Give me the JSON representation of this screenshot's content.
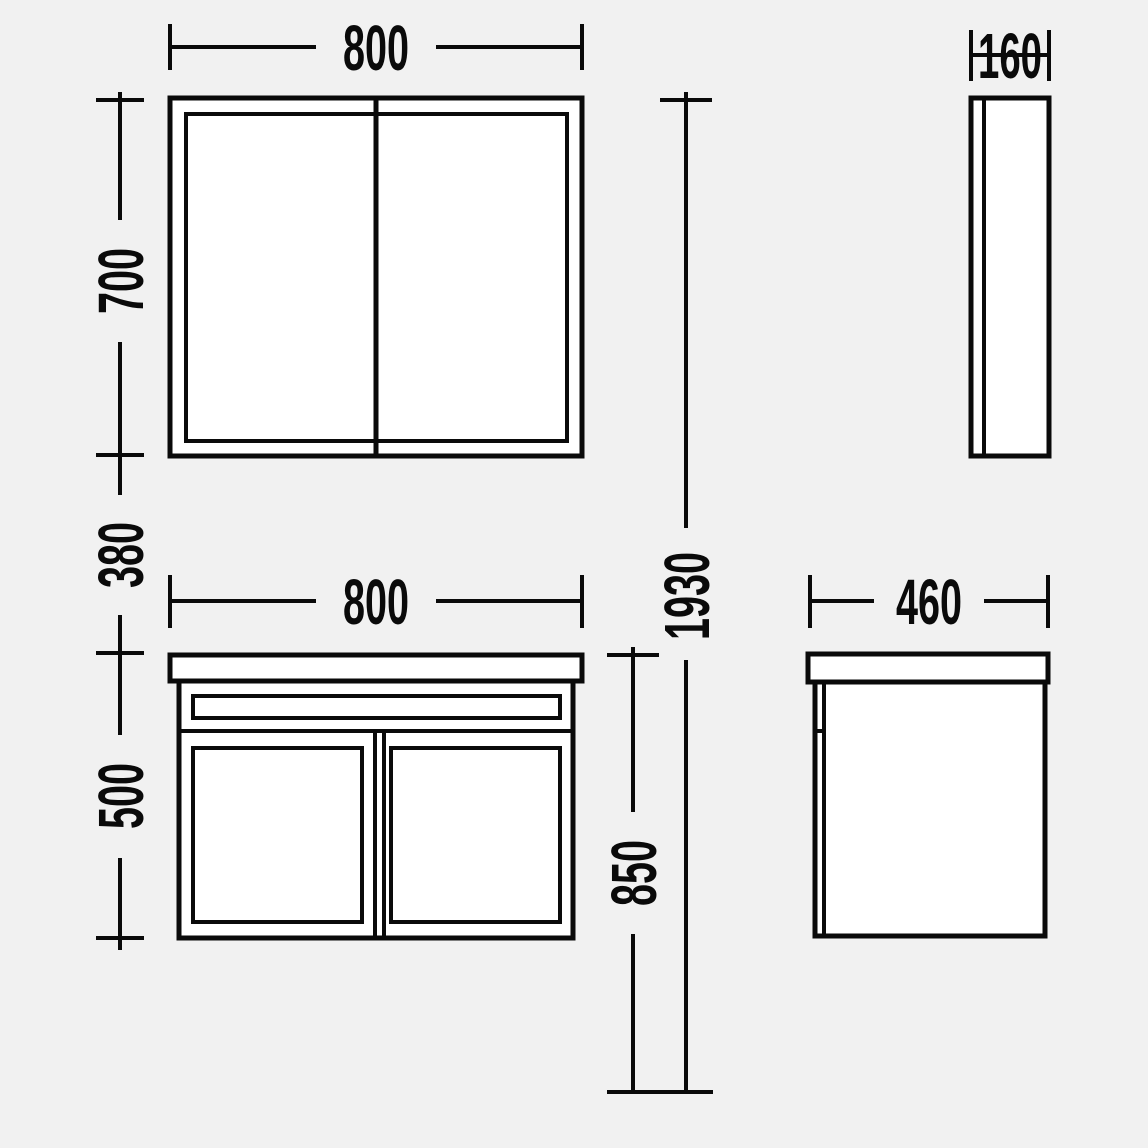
{
  "drawing": {
    "background": "#f1f1f1",
    "ink": "#0a0a0a",
    "fill": "#ffffff"
  },
  "dims": {
    "mirror_width": "800",
    "mirror_depth": "160",
    "mirror_height": "700",
    "wall_gap": "380",
    "vanity_width": "800",
    "vanity_height": "500",
    "vanity_depth": "460",
    "worktop_height": "850",
    "total_height": "1930"
  }
}
